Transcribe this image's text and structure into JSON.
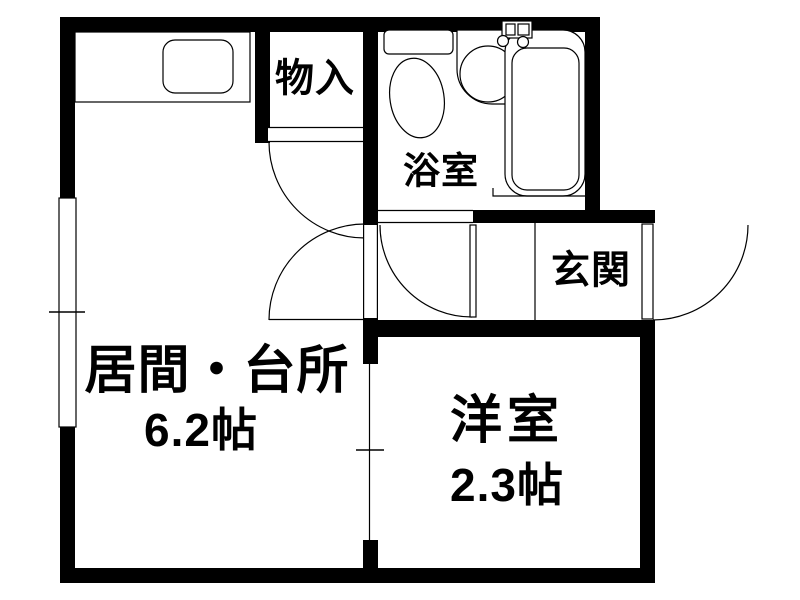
{
  "plan": {
    "background": "#ffffff",
    "wall_color": "#000000",
    "line_color": "#000000",
    "rooms": {
      "living_kitchen": {
        "label": "居間・台所",
        "area": "6.2帖"
      },
      "western_room": {
        "label": "洋室",
        "area": "2.3帖"
      },
      "storage": {
        "label": "物入"
      },
      "bathroom": {
        "label": "浴室"
      },
      "entrance": {
        "label": "玄関"
      }
    }
  }
}
